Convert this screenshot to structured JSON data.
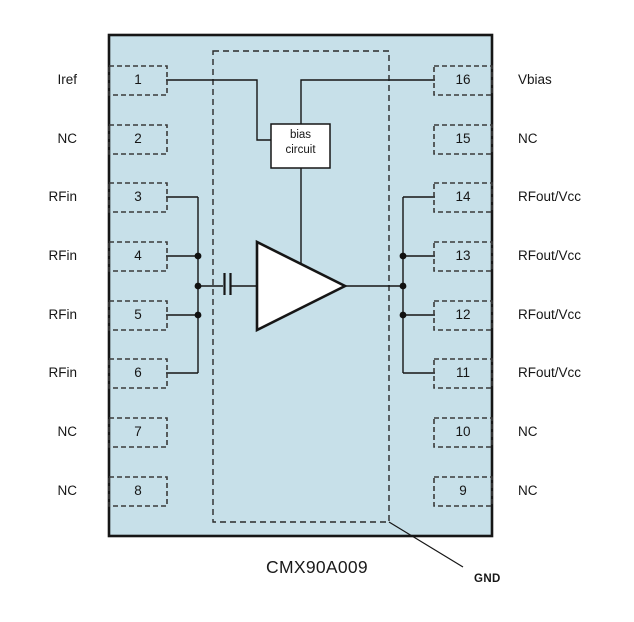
{
  "diagram": {
    "part_number": "CMX90A009",
    "ground_label": "GND",
    "bias_box": {
      "line1": "bias",
      "line2": "circuit"
    },
    "colors": {
      "chip_fill": "#C7E0E9",
      "line": "#161616",
      "block_fill": "#FFFFFF",
      "dashed_stroke": "#3A3A3A"
    },
    "pins": {
      "left": [
        {
          "number": "1",
          "label": "Iref"
        },
        {
          "number": "2",
          "label": "NC"
        },
        {
          "number": "3",
          "label": "RFin"
        },
        {
          "number": "4",
          "label": "RFin"
        },
        {
          "number": "5",
          "label": "RFin"
        },
        {
          "number": "6",
          "label": "RFin"
        },
        {
          "number": "7",
          "label": "NC"
        },
        {
          "number": "8",
          "label": "NC"
        }
      ],
      "right": [
        {
          "number": "16",
          "label": "Vbias"
        },
        {
          "number": "15",
          "label": "NC"
        },
        {
          "number": "14",
          "label": "RFout/Vcc"
        },
        {
          "number": "13",
          "label": "RFout/Vcc"
        },
        {
          "number": "12",
          "label": "RFout/Vcc"
        },
        {
          "number": "11",
          "label": "RFout/Vcc"
        },
        {
          "number": "10",
          "label": "NC"
        },
        {
          "number": "9",
          "label": "NC"
        }
      ]
    }
  }
}
